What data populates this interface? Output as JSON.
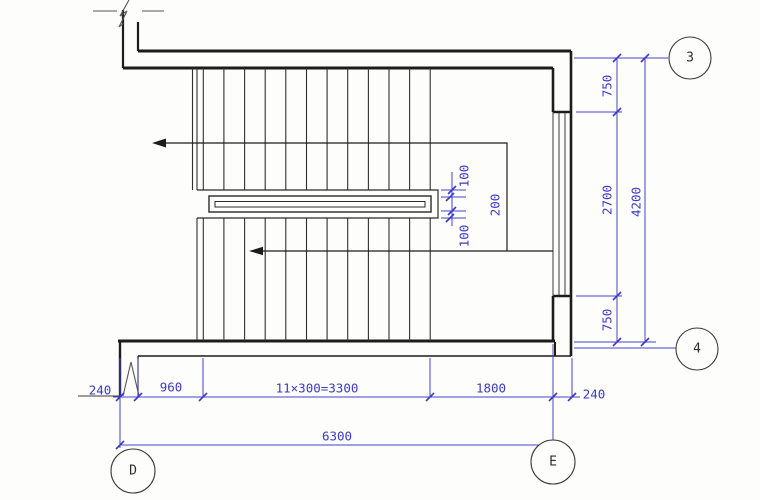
{
  "dims": {
    "wall_left": "240",
    "entry_width": "960",
    "treads": "11×300=3300",
    "landing_width": "1800",
    "wall_right": "240",
    "total_width": "6300",
    "top_offset": "750",
    "window_width": "2700",
    "bottom_offset": "750",
    "total_height": "4200",
    "well_gap_top": "100",
    "handrail_width": "200",
    "well_gap_bottom": "100"
  },
  "grid": {
    "col_3": "3",
    "col_4": "4",
    "row_d": "D",
    "row_e": "E"
  },
  "colors": {
    "dimension_blue": "#3d39c4",
    "linework_black": "#1c1c1c"
  }
}
